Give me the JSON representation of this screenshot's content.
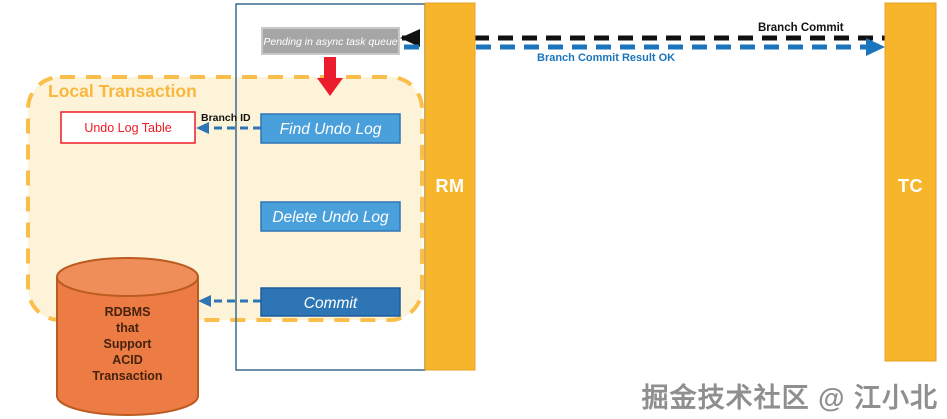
{
  "lanes": {
    "rm": "RM",
    "tc": "TC"
  },
  "local_transaction_label": "Local Transaction",
  "nodes": {
    "pending": "Pending in async task queue",
    "find_undo_log": "Find Undo Log",
    "delete_undo_log": "Delete Undo Log",
    "commit": "Commit",
    "undo_log_table": "Undo Log Table"
  },
  "database": {
    "lines": [
      "RDBMS",
      "that",
      "Support",
      "ACID",
      "Transaction"
    ]
  },
  "messages": {
    "branch_commit": "Branch Commit",
    "branch_commit_result": "Branch Commit Result OK",
    "branch_id": "Branch ID"
  },
  "watermark": "掘金技术社区 @ 江小北",
  "colors": {
    "lane_fill": "#F7B52C",
    "lane_border": "#E8A224",
    "local_transaction_fill": "#FCF3D8",
    "local_transaction_border": "#FBBE4B",
    "local_transaction_label": "#F9B73E",
    "action_box_fill": "#4AA0DA",
    "action_box_border": "#2E75B6",
    "commit_box_fill": "#2E75B6",
    "commit_box_border": "#1F5C99",
    "pending_box_fill": "#A6A6A6",
    "pending_box_border": "#C8C8C8",
    "undo_table_border": "#ED1C24",
    "red_arrow": "#EC1B2E",
    "blue_arrow": "#1B75BC",
    "black_arrow": "#111111",
    "cylinder_body": "#EC7B44",
    "cylinder_top": "#EF8E58",
    "cylinder_outline": "#BC5B20",
    "container_border": "#3A6B8E",
    "watermark_gray": "#8F8F8F"
  }
}
